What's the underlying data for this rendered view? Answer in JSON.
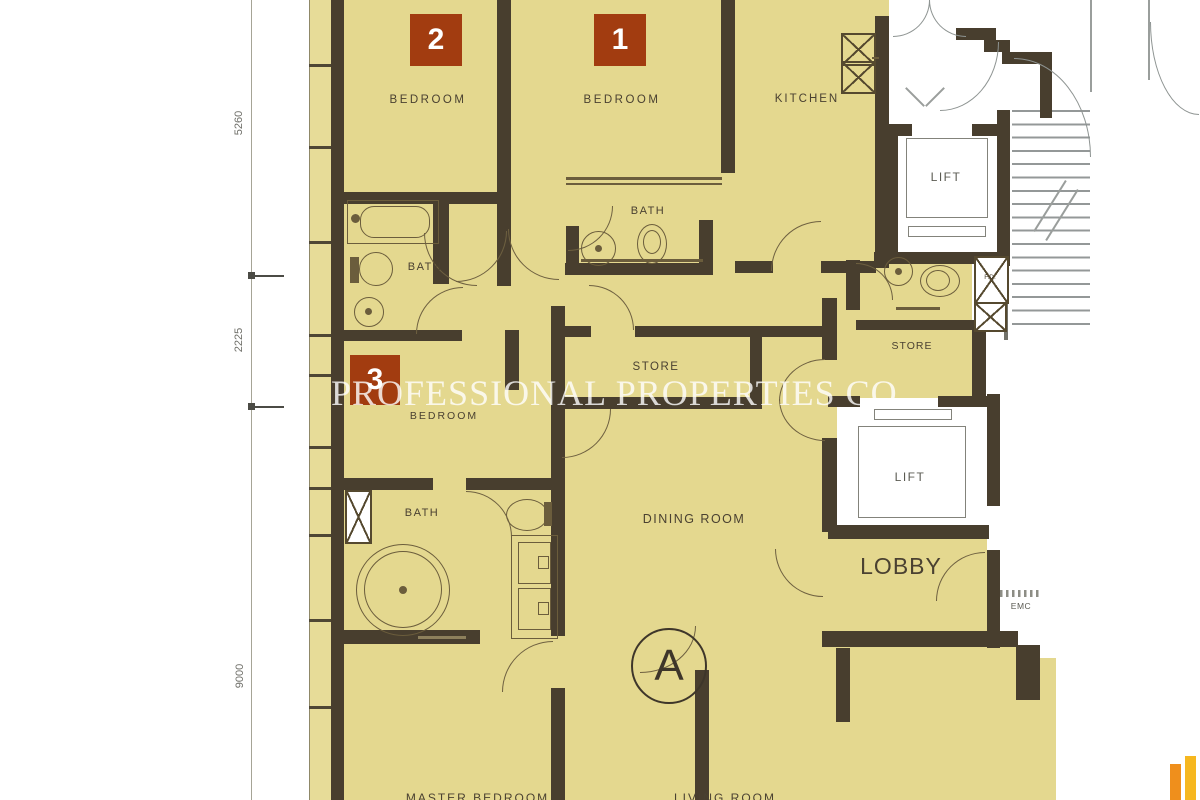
{
  "plan": {
    "watermark": "PROFESSIONAL PROPERTIES CO.",
    "unit_label": "A",
    "badges": [
      {
        "number": "2"
      },
      {
        "number": "1"
      },
      {
        "number": "3"
      }
    ],
    "rooms": {
      "bedroom2": "BEDROOM",
      "bedroom1": "BEDROOM",
      "bedroom3": "BEDROOM",
      "kitchen": "KITCHEN",
      "bath2": "BATH",
      "bath1": "BATH",
      "master_bath": "BATH",
      "store1": "STORE",
      "store2": "STORE",
      "dining_room": "DINING ROOM",
      "lobby": "LOBBY",
      "lift1": "LIFT",
      "lift2": "LIFT",
      "emc": "EMC",
      "fd": "F.D.",
      "master_bedroom_partial": "MASTER BEDROOM",
      "living_room_partial": "LIVING ROOM"
    },
    "dimensions": {
      "d1": "5260",
      "d2": "2225",
      "d3": "9000"
    },
    "colors": {
      "room_fill": "#e4d88f",
      "wall": "#483e2e",
      "badge": "#a23c10",
      "logo_orange": "#ef8f1c",
      "watermark_white": "rgba(255,255,255,0.8)"
    }
  }
}
